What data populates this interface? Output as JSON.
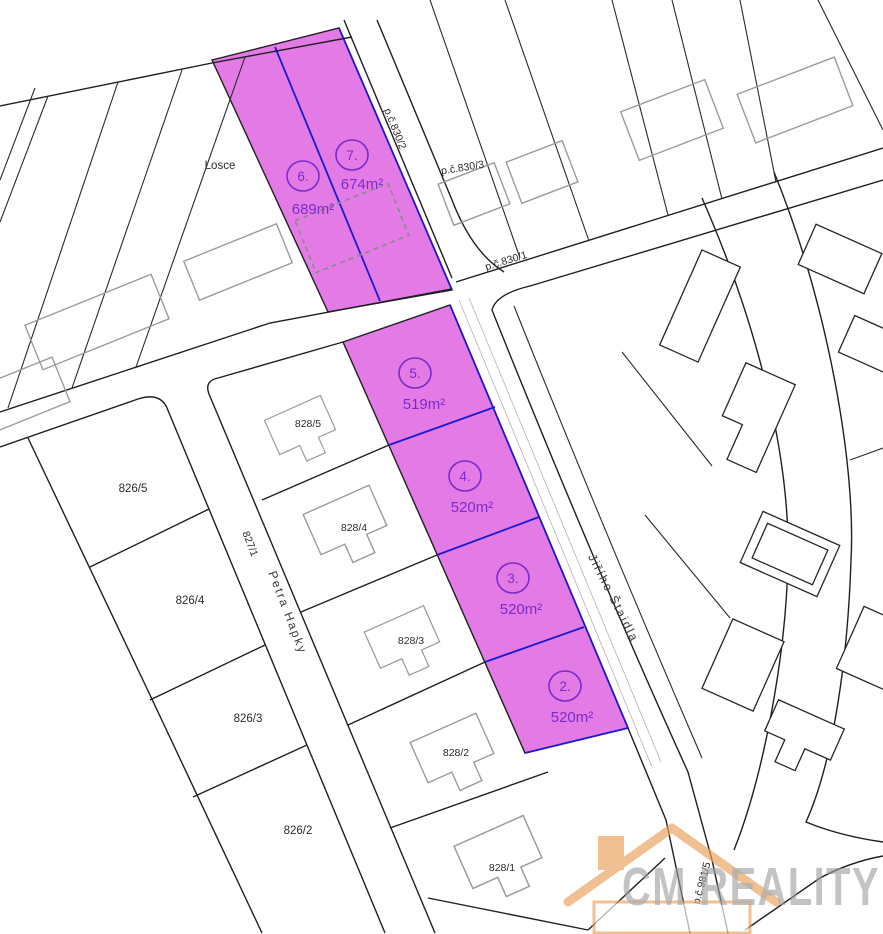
{
  "map": {
    "region_label": "Losce",
    "highlight_parcels": [
      {
        "number": "7.",
        "area": "674m²"
      },
      {
        "number": "6.",
        "area": "689m²"
      },
      {
        "number": "5.",
        "area": "519m²"
      },
      {
        "number": "4.",
        "area": "520m²"
      },
      {
        "number": "3.",
        "area": "520m²"
      },
      {
        "number": "2.",
        "area": "520m²"
      }
    ],
    "road_labels": {
      "p830_2": "p.č.830/2",
      "p830_3": "p.č.830/3",
      "p830_1": "p.č.830/1",
      "p981_5": "p.č.981/5"
    },
    "street_labels": {
      "west_parcel": "827/1",
      "west_name": "Petra Hapky",
      "east_name": "Jiřího Štaidla"
    },
    "parcel_labels": [
      "826/5",
      "826/4",
      "826/3",
      "826/2"
    ],
    "house_labels": [
      "828/5",
      "828/4",
      "828/3",
      "828/2",
      "828/1"
    ]
  },
  "watermark": {
    "text": "CM REALITY"
  },
  "colors": {
    "highlight_fill": "#E47AE6",
    "boundary_blue": "#1A1ACF",
    "label_purple": "#7C2BCB",
    "line_black": "#1f1f1f",
    "building_gray": "#9b9b9b",
    "watermark_gray": "#9e9e9e",
    "watermark_orange": "#E9A35F"
  }
}
